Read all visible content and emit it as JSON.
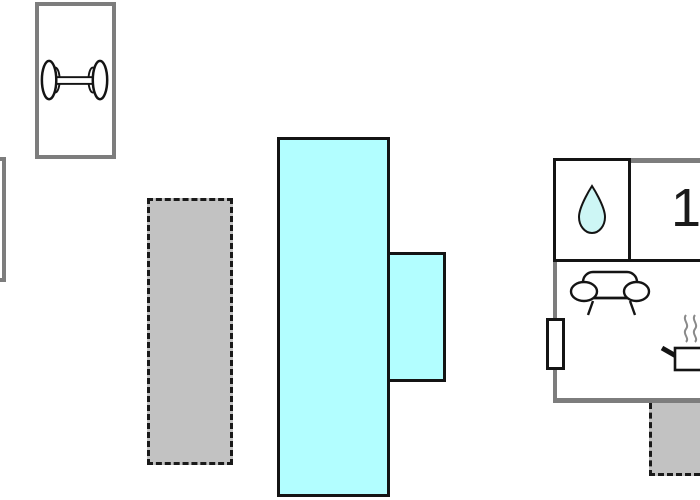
{
  "floorplan": {
    "rooms": {
      "room1": {
        "number": "1"
      },
      "bathroom": {
        "icon": "water-drop-icon"
      },
      "fitness": {
        "icon": "dumbbell-icon"
      },
      "living": {
        "icons": [
          "sofa-icon",
          "cooking-pot-icon"
        ]
      }
    },
    "icons": {
      "dumbbell": "dumbbell-icon",
      "water_drop": "water-drop-icon",
      "sofa": "sofa-icon",
      "cooking_pot": "cooking-pot-icon",
      "steam": "steam-icon"
    },
    "colors": {
      "pool_fill": "#b2feff",
      "droplet_fill": "#cdf6f5",
      "area_fill_gray": "#c2c2c2",
      "wall_gray": "#7d7d7d",
      "outline_black": "#141414",
      "background": "#ffffff"
    }
  }
}
